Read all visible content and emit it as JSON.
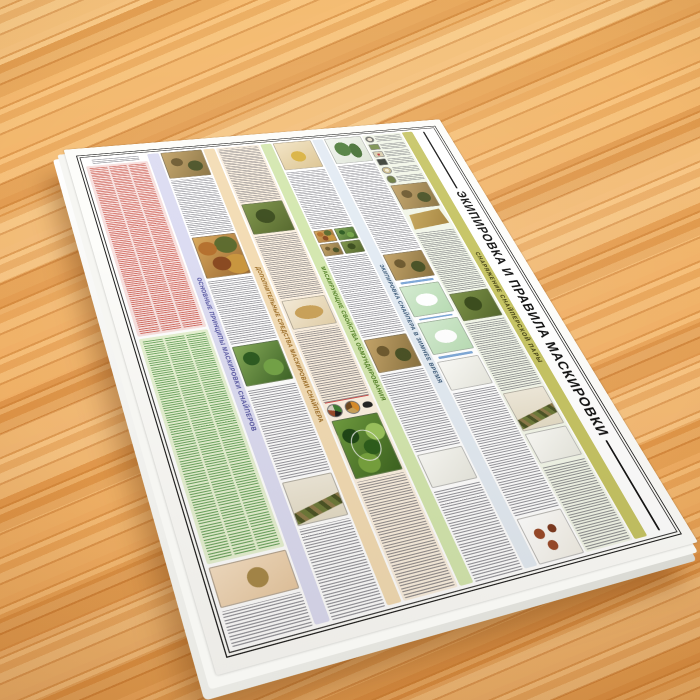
{
  "scene": {
    "surface": "wooden table top",
    "wood_base_color": "#eda75c",
    "board_material_color": "#ffffff"
  },
  "poster": {
    "title": "ЭКИПИРОВКА И ПРАВИЛА МАСКИРОВКИ",
    "title_color": "#121212",
    "side_band_label": "СНАРЯЖЕНИЕ СНАЙПЕРСКОЙ ПАРЫ",
    "side_band_bg": "#c6c464",
    "side_band_ink": "#3d3a10",
    "sections": [
      {
        "label": "ОСНОВНЫЕ ПРИНЦИПЫ МАСКИРОВКИ СНАЙПЕРОВ",
        "band": "#dcdcf2",
        "ink": "#50509e"
      },
      {
        "label": "ДОПОЛНИТЕЛЬНЫЕ СРЕДСТВА МАСКИРОВКИ СНАЙПЕРА",
        "band": "#f3dcb4",
        "ink": "#96661e"
      },
      {
        "label": "МАСКИРУЮЩИЕ СВОЙСТВА ОБМУНДИРОВАНИЯ",
        "band": "#d4e7af",
        "ink": "#49791c"
      },
      {
        "label": "ЭКИПИРОВКА СНАЙПЕРА В ЗИМНЕЕ ВРЕМЯ",
        "band": "#e3ebf3",
        "ink": "#31506f"
      }
    ],
    "list_blocks": [
      {
        "name": "principles-list-red",
        "bg": "#f8e0de",
        "ink": "#c0392b"
      },
      {
        "name": "principles-list-green",
        "bg": "#e6f2d2",
        "ink": "#438c3a"
      }
    ],
    "frame_color": "#1c1c1c"
  }
}
